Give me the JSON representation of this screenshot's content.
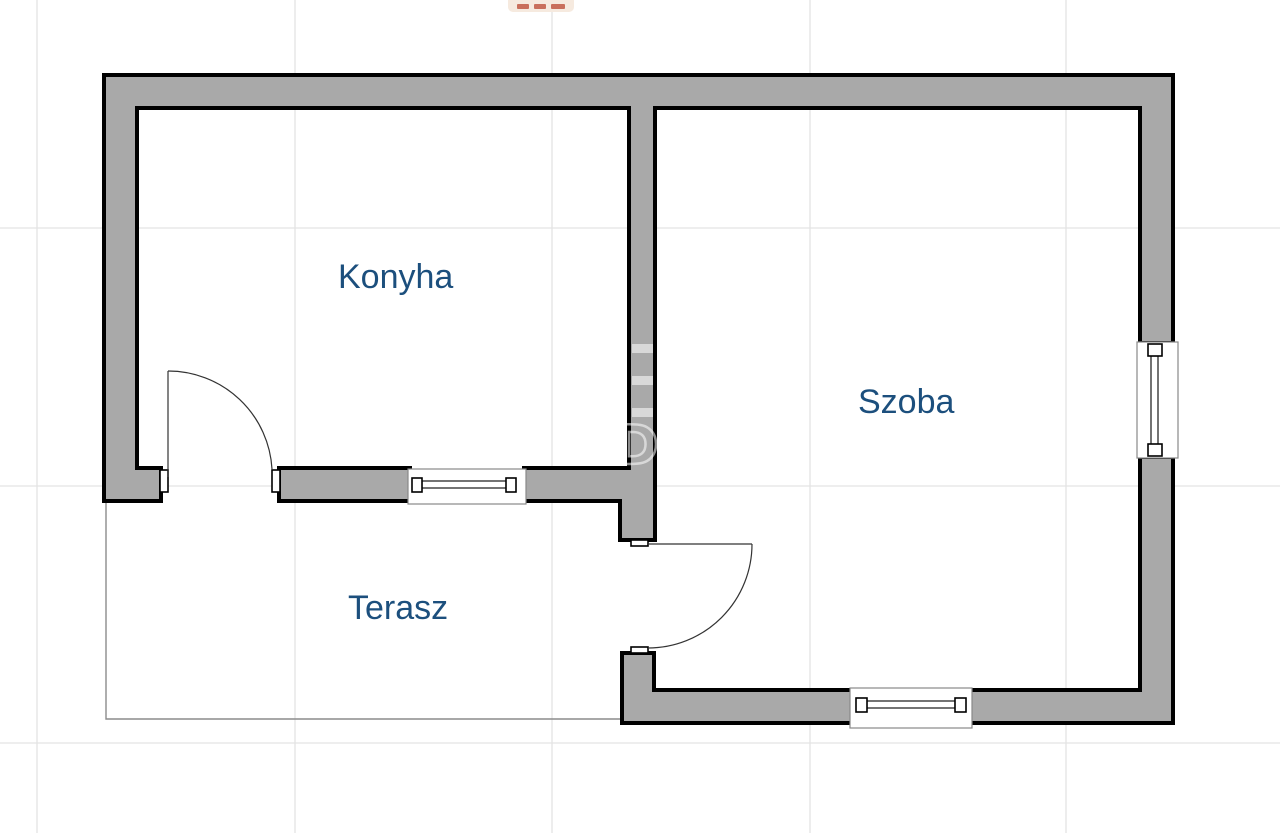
{
  "theme": {
    "background": "#ffffff",
    "wall_fill": "#a9a9a9",
    "wall_stroke": "#000000",
    "grid_color": "#e3e3e3",
    "terrace_line_color": "#8c8c8c",
    "label_color": "#1c4f7d",
    "door_line_color": "#333333",
    "window_frame_stroke": "#888888",
    "top_marks_color": "#c96f5c",
    "top_marks_bg": "#f6eadf",
    "watermark_color": "rgba(255,255,255,0.55)"
  },
  "floorplan": {
    "type": "residential-floor-plan",
    "rooms": [
      {
        "name": "konyha",
        "label": "Konyha"
      },
      {
        "name": "szoba",
        "label": "Szoba"
      },
      {
        "name": "terasz",
        "label": "Terasz"
      }
    ],
    "door_count": 2,
    "window_count": 3
  },
  "watermark": {
    "letter": "D"
  }
}
